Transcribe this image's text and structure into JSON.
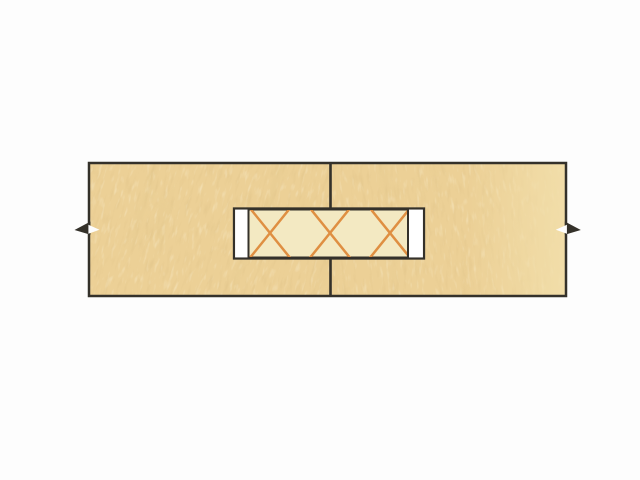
{
  "figure": {
    "description": "Cross-section diagram of two boards joined edge to edge with a compressed beech biscuit glued into matching slots; break symbols indicate boards continue beyond the drawing",
    "parts": {
      "left_board": "left board (end-grain section)",
      "right_board": "right board (end-grain section)",
      "joint_line": "glue line between boards",
      "slot": "biscuit slot (mortise)",
      "slot_gap_left": "clearance gap at left end of slot",
      "slot_gap_right": "clearance gap at right end of slot",
      "biscuit": "biscuit spline with cross-hatch section marking",
      "break_mark_left": "break symbol, left edge",
      "break_mark_right": "break symbol, right edge"
    }
  },
  "colors": {
    "background": "#fdfdfd",
    "wood_base": "#ecd096",
    "wood_wash": "#f2dfab",
    "outline": "#34312a",
    "slot_gap": "#ffffff",
    "biscuit_fill": "#f3e9c2",
    "hatch": "#df8f42"
  }
}
